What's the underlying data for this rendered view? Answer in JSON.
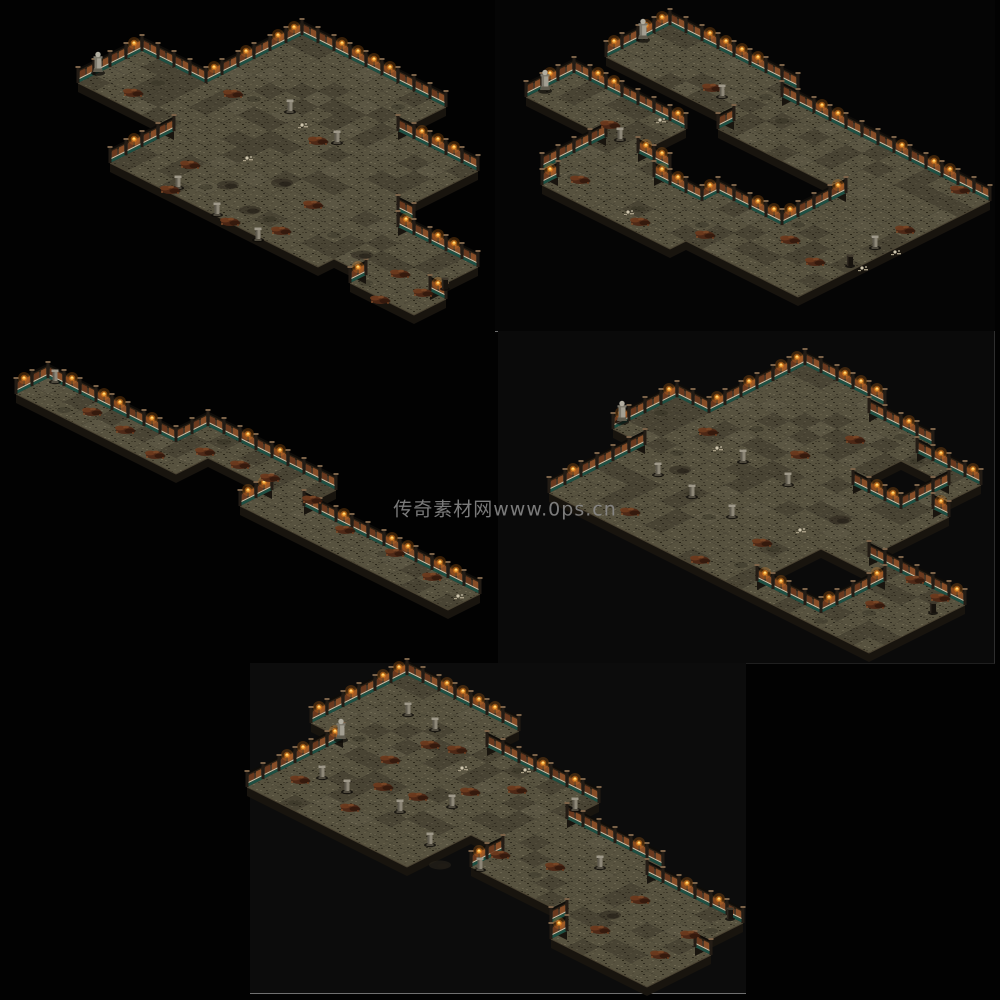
{
  "page": {
    "background": "#020202",
    "watermark": {
      "text": "传奇素材网www.0ps.cn",
      "x": 505,
      "y": 508,
      "color": "#8f8f8f",
      "font_size": 19
    }
  },
  "panels": [
    {
      "name": "image-tile-top-right",
      "x": 495,
      "y": 0,
      "w": 500,
      "h": 331,
      "bg": "#050505",
      "border_bottom": "#6f6f6f",
      "border_right": ""
    },
    {
      "name": "image-tile-mid-right",
      "x": 498,
      "y": 331,
      "w": 496,
      "h": 332,
      "bg": "#0a0a0a",
      "border_bottom": "#1f1f1f",
      "border_right": "#2e2e2e"
    },
    {
      "name": "image-tile-bottom",
      "x": 250,
      "y": 663,
      "w": 496,
      "h": 330,
      "bg": "#0c0c0c",
      "border_bottom": "#707070",
      "border_right": ""
    }
  ],
  "tile": {
    "w": 32,
    "h": 16,
    "wall_h": 13,
    "cliff_d": 9
  },
  "palette": {
    "floor_base": "#57523f",
    "floor_speckles": [
      "#3b3628",
      "#6a644f",
      "#45402f",
      "#302c20",
      "#625c47",
      "#6e6852",
      "#2b2719",
      "#514b39"
    ],
    "floor_dark": "#262218",
    "floor_light": "#7a7260",
    "cliff": "#18140e",
    "cliff_lip": "#4d4534",
    "wall_body": "#4c3827",
    "wall_body_dark": "#2b2014",
    "wall_panel": "#8a4f28",
    "wall_panel2": "#6b3a1f",
    "wall_teal": "#1d5044",
    "wall_rail": "#c9c3ad",
    "wall_cap": "#0e0c09",
    "wall_post": "#231c15",
    "wall_post_cap": "#7b6248",
    "torch_glow": "#ff8c1e",
    "torch_flame": "#ffb340",
    "torch_core": "#ffe28a",
    "statue_body": "#a39f92",
    "statue_dark": "#7c786c",
    "statue_head": "#b2aea1",
    "statue_base": "#5f5b4e",
    "pillar_light": "#8d8778",
    "pillar_dark": "#615c50",
    "pillar_cap": "#9e9889",
    "pillar_base": "#4f4a3e",
    "debris": [
      "#4e2715",
      "#6e3b1e",
      "#33180c",
      "#7e4a28"
    ],
    "dirt": "#2c271d",
    "dirt2": "#211d15",
    "bones": "#cfc6ae",
    "bones2": "#a89e86",
    "stump": "#16120d",
    "stump_top": "#3f382c",
    "shadow": "#0c0a07"
  },
  "maps": [
    {
      "name": "map-image-1",
      "origin": [
        302,
        35
      ],
      "blocks": [
        [
          0,
          8,
          0,
          2
        ],
        [
          0,
          13,
          3,
          7
        ],
        [
          2,
          14,
          8,
          13
        ],
        [
          -4,
          1,
          6,
          9
        ],
        [
          15,
          19,
          9,
          12
        ],
        [
          17,
          20,
          12,
          13
        ]
      ],
      "holes": [],
      "entities": [
        [
          "statue",
          98,
          72
        ],
        [
          "pillar",
          290,
          112
        ],
        [
          "pillar",
          337,
          143
        ],
        [
          "pillar",
          178,
          188
        ],
        [
          "pillar",
          217,
          215
        ],
        [
          "pillar",
          258,
          240
        ],
        [
          "bones",
          247,
          158
        ],
        [
          "bones",
          302,
          125
        ],
        [
          "debris",
          133,
          93
        ],
        [
          "debris",
          233,
          94
        ],
        [
          "debris",
          190,
          165
        ],
        [
          "debris",
          170,
          190
        ],
        [
          "debris",
          230,
          222
        ],
        [
          "debris",
          281,
          231
        ],
        [
          "debris",
          318,
          141
        ],
        [
          "debris",
          313,
          205
        ],
        [
          "debris",
          400,
          274
        ],
        [
          "debris",
          380,
          300
        ],
        [
          "debris",
          423,
          293
        ],
        [
          "dirt",
          228,
          185
        ],
        [
          "dirt",
          282,
          183
        ],
        [
          "dirt",
          362,
          255
        ],
        [
          "dirt",
          250,
          210
        ],
        [
          "stump",
          445,
          288
        ]
      ]
    },
    {
      "name": "map-image-2",
      "origin": [
        670,
        25
      ],
      "blocks": [
        [
          0,
          7,
          0,
          3
        ],
        [
          8,
          20,
          1,
          4
        ],
        [
          16,
          20,
          5,
          8
        ],
        [
          12,
          20,
          9,
          12
        ],
        [
          6,
          13,
          10,
          13
        ],
        [
          5,
          8,
          9,
          12
        ],
        [
          0,
          6,
          6,
          8
        ]
      ],
      "holes": [],
      "entities": [
        [
          "statue",
          643,
          39
        ],
        [
          "statue",
          545,
          90
        ],
        [
          "pillar",
          620,
          140
        ],
        [
          "pillar",
          875,
          248
        ],
        [
          "pillar",
          722,
          97
        ],
        [
          "debris",
          712,
          88
        ],
        [
          "debris",
          610,
          125
        ],
        [
          "debris",
          580,
          180
        ],
        [
          "debris",
          705,
          235
        ],
        [
          "debris",
          790,
          240
        ],
        [
          "debris",
          905,
          230
        ],
        [
          "debris",
          960,
          190
        ],
        [
          "debris",
          815,
          262
        ],
        [
          "debris",
          640,
          222
        ],
        [
          "bones",
          660,
          120
        ],
        [
          "bones",
          628,
          212
        ],
        [
          "bones",
          862,
          268
        ],
        [
          "bones",
          895,
          252
        ],
        [
          "stump",
          850,
          265
        ]
      ]
    },
    {
      "name": "map-image-3",
      "origin": [
        112,
        346
      ],
      "blocks": [
        [
          0,
          8,
          4,
          5
        ],
        [
          8,
          9,
          2,
          5
        ],
        [
          9,
          14,
          2,
          3
        ],
        [
          14,
          15,
          2,
          5
        ],
        [
          15,
          26,
          4,
          5
        ]
      ],
      "holes": [],
      "entities": [
        [
          "pillar",
          55,
          382
        ],
        [
          "debris",
          92,
          412
        ],
        [
          "debris",
          125,
          430
        ],
        [
          "debris",
          155,
          455
        ],
        [
          "debris",
          205,
          452
        ],
        [
          "debris",
          240,
          465
        ],
        [
          "debris",
          270,
          478
        ],
        [
          "debris",
          312,
          500
        ],
        [
          "debris",
          345,
          530
        ],
        [
          "debris",
          395,
          553
        ],
        [
          "debris",
          432,
          577
        ],
        [
          "bones",
          458,
          596
        ]
      ]
    },
    {
      "name": "map-image-4",
      "origin": [
        805,
        365
      ],
      "blocks": [
        [
          0,
          4,
          0,
          4
        ],
        [
          5,
          8,
          1,
          4
        ],
        [
          9,
          12,
          2,
          6
        ],
        [
          0,
          13,
          5,
          9
        ],
        [
          -2,
          3,
          6,
          9
        ],
        [
          0,
          6,
          10,
          15
        ],
        [
          7,
          19,
          10,
          15
        ]
      ],
      "holes": [
        [
          9,
          11,
          3,
          5
        ],
        [
          12,
          15,
          11,
          14
        ]
      ],
      "entities": [
        [
          "statue",
          622,
          421
        ],
        [
          "pillar",
          658,
          475
        ],
        [
          "pillar",
          692,
          497
        ],
        [
          "pillar",
          743,
          462
        ],
        [
          "pillar",
          788,
          485
        ],
        [
          "pillar",
          732,
          517
        ],
        [
          "debris",
          708,
          432
        ],
        [
          "debris",
          630,
          512
        ],
        [
          "debris",
          700,
          560
        ],
        [
          "debris",
          762,
          543
        ],
        [
          "debris",
          800,
          455
        ],
        [
          "debris",
          855,
          440
        ],
        [
          "debris",
          915,
          580
        ],
        [
          "debris",
          875,
          605
        ],
        [
          "debris",
          940,
          598
        ],
        [
          "bones",
          717,
          448
        ],
        [
          "bones",
          800,
          530
        ],
        [
          "dirt",
          680,
          470
        ],
        [
          "dirt",
          840,
          520
        ],
        [
          "stump",
          933,
          612
        ]
      ]
    },
    {
      "name": "map-image-5",
      "origin": [
        407,
        675
      ],
      "blocks": [
        [
          0,
          6,
          0,
          5
        ],
        [
          2,
          6,
          6,
          11
        ],
        [
          7,
          13,
          2,
          7
        ],
        [
          14,
          19,
          4,
          9
        ],
        [
          20,
          25,
          5,
          10
        ],
        [
          21,
          26,
          8,
          11
        ],
        [
          7,
          11,
          8,
          11
        ]
      ],
      "holes": [],
      "entities": [
        [
          "statue",
          341,
          739
        ],
        [
          "pillar",
          322,
          778
        ],
        [
          "pillar",
          347,
          792
        ],
        [
          "pillar",
          400,
          812
        ],
        [
          "pillar",
          452,
          807
        ],
        [
          "pillar",
          430,
          845
        ],
        [
          "pillar",
          480,
          870
        ],
        [
          "pillar",
          575,
          810
        ],
        [
          "pillar",
          600,
          868
        ],
        [
          "pillar",
          408,
          715
        ],
        [
          "pillar",
          435,
          730
        ],
        [
          "debris",
          430,
          745
        ],
        [
          "debris",
          457,
          750
        ],
        [
          "debris",
          390,
          760
        ],
        [
          "debris",
          383,
          787
        ],
        [
          "debris",
          418,
          797
        ],
        [
          "debris",
          470,
          792
        ],
        [
          "debris",
          517,
          790
        ],
        [
          "debris",
          555,
          867
        ],
        [
          "debris",
          500,
          855
        ],
        [
          "debris",
          600,
          930
        ],
        [
          "debris",
          660,
          955
        ],
        [
          "debris",
          690,
          935
        ],
        [
          "debris",
          640,
          900
        ],
        [
          "debris",
          350,
          808
        ],
        [
          "debris",
          300,
          780
        ],
        [
          "bones",
          462,
          768
        ],
        [
          "bones",
          525,
          770
        ],
        [
          "dirt",
          440,
          865
        ],
        [
          "dirt",
          610,
          915
        ],
        [
          "stump",
          730,
          918
        ]
      ]
    }
  ]
}
